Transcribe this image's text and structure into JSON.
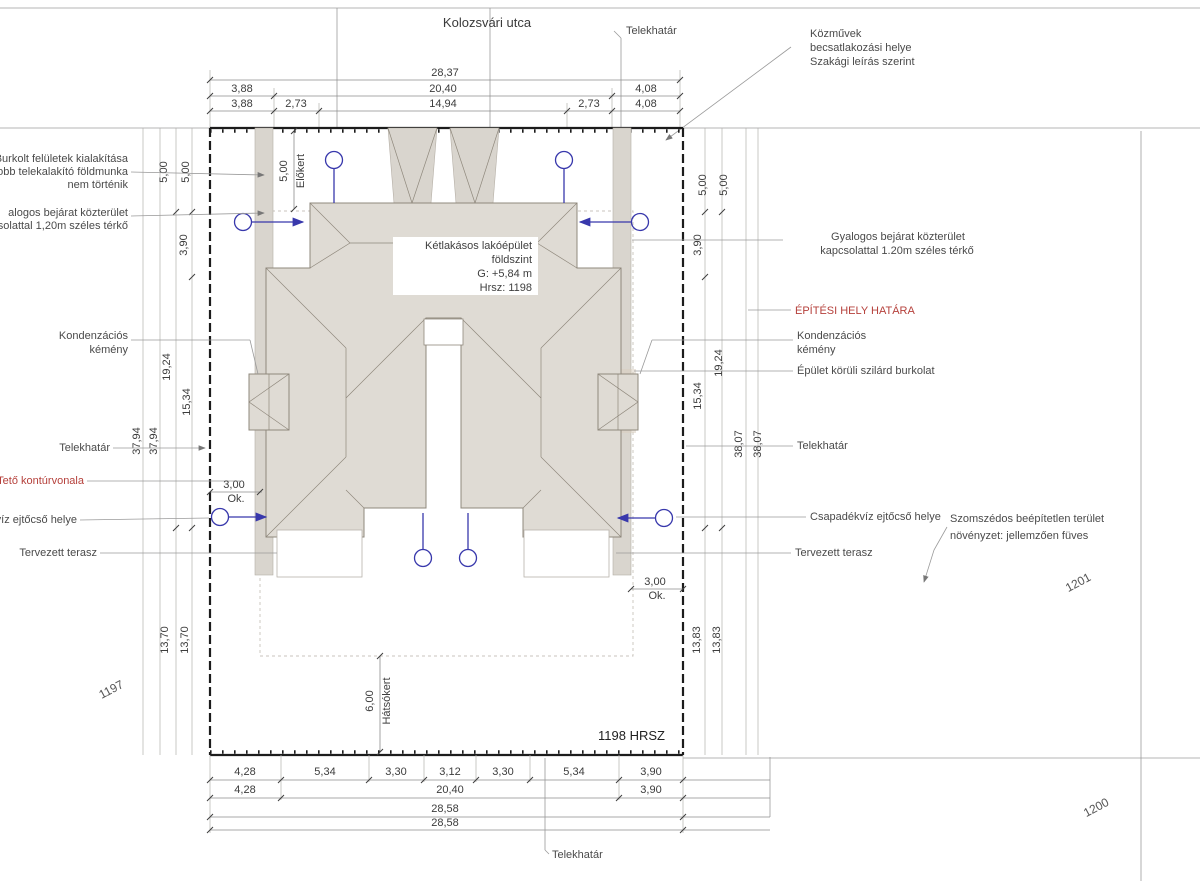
{
  "street_title": "Kolozsvári utca",
  "top": {
    "telekhatar": "Telekhatár",
    "kozmuvek_1": "Közművek",
    "kozmuvek_2": "becsatlakozási helye",
    "kozmuvek_3": "Szakági leírás szerint"
  },
  "dims_top": {
    "a1": "28,37",
    "b1": "3,88",
    "b2": "20,40",
    "b3": "4,08",
    "c1": "3,88",
    "c2": "2,73",
    "c3": "14,94",
    "c4": "2,73",
    "c5": "4,08"
  },
  "dims_bottom": {
    "r1_1": "4,28",
    "r1_2": "5,34",
    "r1_3": "3,30",
    "r1_4": "3,12",
    "r1_5": "3,30",
    "r1_6": "5,34",
    "r1_7": "3,90",
    "r2_1": "4,28",
    "r2_2": "20,40",
    "r2_3": "3,90",
    "r3": "28,58",
    "r4": "28,58",
    "telekhatar": "Telekhatár"
  },
  "dims_left": {
    "d500a": "5,00",
    "d500b": "5,00",
    "d390": "3,90",
    "d1924": "19,24",
    "d1534": "15,34",
    "d3794a": "37,94",
    "d3794b": "37,94",
    "d1370a": "13,70",
    "d1370b": "13,70"
  },
  "dims_right": {
    "d500a": "5,00",
    "d500b": "5,00",
    "d390": "3,90",
    "d1924": "19,24",
    "d1534": "15,34",
    "d3807a": "38,07",
    "d3807b": "38,07",
    "d1383a": "13,83",
    "d1383b": "13,83"
  },
  "labels_left": {
    "burkolt_1": "Burkolt felületek kialakítása",
    "burkolt_2": "vobb telekalakító földmunka",
    "burkolt_3": "nem történik",
    "bejarat_1": "alogos bejárat közterület",
    "bejarat_2": "pcsolattal 1,20m széles térkő",
    "kemeny_1": "Kondenzációs",
    "kemeny_2": "kémény",
    "telekhatar": "Telekhatár",
    "teto": "Tető kontúrvonala",
    "ejtocso": "kvíz ejtőcső helye",
    "terasz": "Tervezett terasz"
  },
  "labels_right": {
    "bejarat_1": "Gyalogos bejárat közterület",
    "bejarat_2": "kapcsolattal 1.20m széles térkő",
    "epitesi": "ÉPÍTÉSI HELY HATÁRA",
    "kemeny_1": "Kondenzációs",
    "kemeny_2": "kémény",
    "burkolat": "Épület körüli szilárd burkolat",
    "telekhatar": "Telekhatár",
    "ejtocso": "Csapadékvíz ejtőcső helye",
    "szomszed_1": "Szomszédos beépítetlen terület",
    "szomszed_2": "növényzet: jellemzően füves",
    "terasz": "Tervezett terasz"
  },
  "building": {
    "l1": "Kétlakásos lakóépület",
    "l2": "földszint",
    "l3": "G: +5,84 m",
    "l4": "Hrsz: 1198"
  },
  "plan": {
    "hrsz": "1198 HRSZ",
    "elokert_v": "5,00",
    "elokert": "Előkert",
    "hatsokert_v": "6,00",
    "hatsokert": "Hátsókert",
    "ok1_v": "3,00",
    "ok1": "Ok.",
    "ok2_v": "3,00",
    "ok2": "Ok."
  },
  "parcels": {
    "left": "1197",
    "right": "1201",
    "bottom": "1200"
  },
  "watermark": "G.D",
  "colors": {
    "downspout_blue": "#3838ac",
    "annotation_red": "#b5403b",
    "roof_fill": "#dfdbd4",
    "roof_stroke": "#8f887c",
    "walkway_gray": "#d9d5ce"
  }
}
